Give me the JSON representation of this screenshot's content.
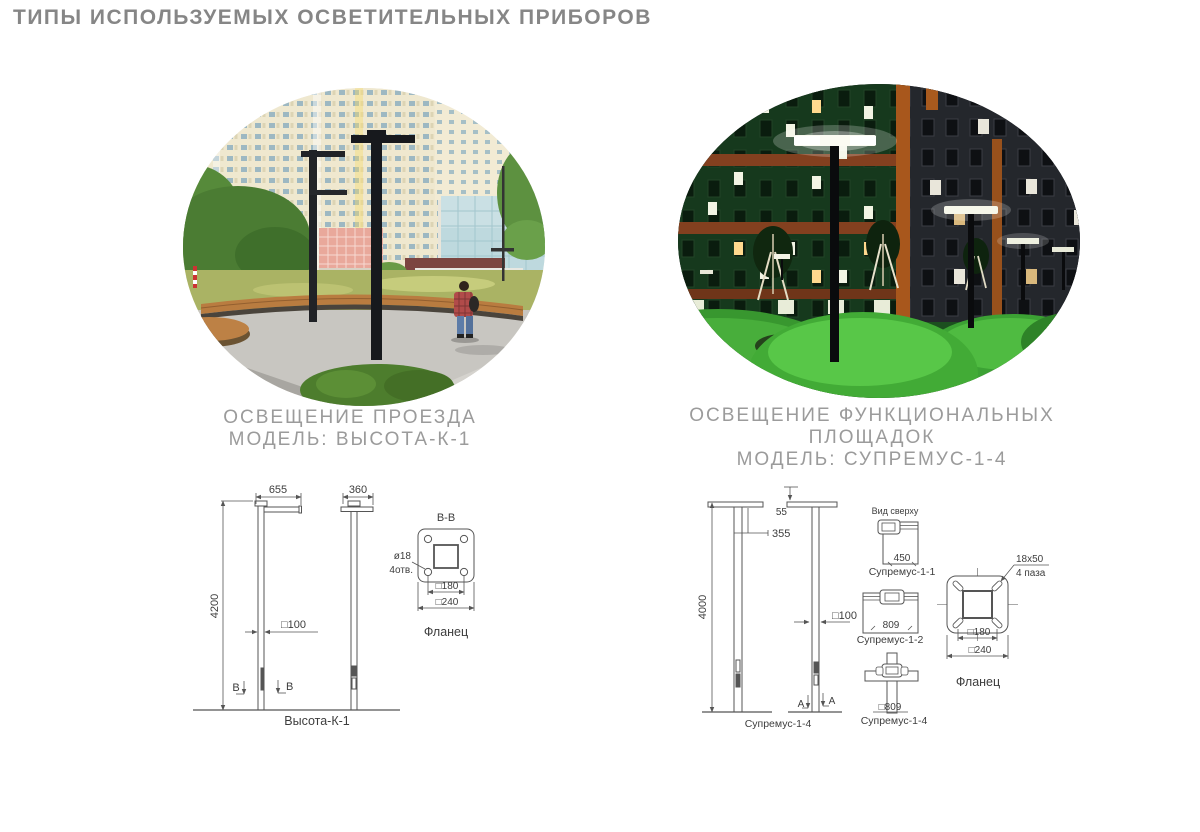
{
  "title": "ТИПЫ ИСПОЛЬЗУЕМЫХ ОСВЕТИТЕЛЬНЫХ ПРИБОРОВ",
  "colors": {
    "title_gray": "#868686",
    "caption_gray": "#9b9b9b",
    "drawing_line": "#555555",
    "drawing_text": "#3d3d3d",
    "day_pavement": "#c8c6c1",
    "bench_wood": "#b97c40",
    "pole_black": "#17191d",
    "night_green_facade": "#16391d",
    "night_grass": "#42ab36",
    "luminaire_white": "#fbfbf2"
  },
  "left": {
    "caption": [
      "ОСВЕЩЕНИЕ ПРОЕЗДА",
      "МОДЕЛЬ: ВЫСОТА-К-1"
    ],
    "drawing": {
      "dim_arm_front": "655",
      "dim_arm_side": "360",
      "dim_height": "4200",
      "dim_section": "□100",
      "section_letter": "B",
      "section_view_title": "B-B",
      "holes_note_line1": "ø18",
      "holes_note_line2": "4отв.",
      "dim_bolt_spacing": "□180",
      "dim_plate": "□240",
      "flange_caption": "Фланец",
      "model_caption": "Высота-К-1"
    }
  },
  "right": {
    "caption": [
      "ОСВЕЩЕНИЕ ФУНКЦИОНАЛЬНЫХ",
      "ПЛОЩАДОК",
      "МОДЕЛЬ: СУПРЕМУС-1-4"
    ],
    "drawing": {
      "dim_plate_offset": "55",
      "dim_arm": "355",
      "dim_height": "4000",
      "dim_section": "□100",
      "section_letter": "A",
      "pole_caption": "Супремус-1-4",
      "top_view_title": "Вид сверху",
      "variants": [
        {
          "dim": "450",
          "label": "Супремус-1-1"
        },
        {
          "dim": "809",
          "label": "Супремус-1-2"
        },
        {
          "dim": "□809",
          "label": "Супремус-1-4"
        }
      ],
      "slots_note_line1": "18x50",
      "slots_note_line2": "4 паза",
      "dim_bolt_spacing": "□180",
      "dim_plate": "□240",
      "flange_caption": "Фланец"
    }
  }
}
